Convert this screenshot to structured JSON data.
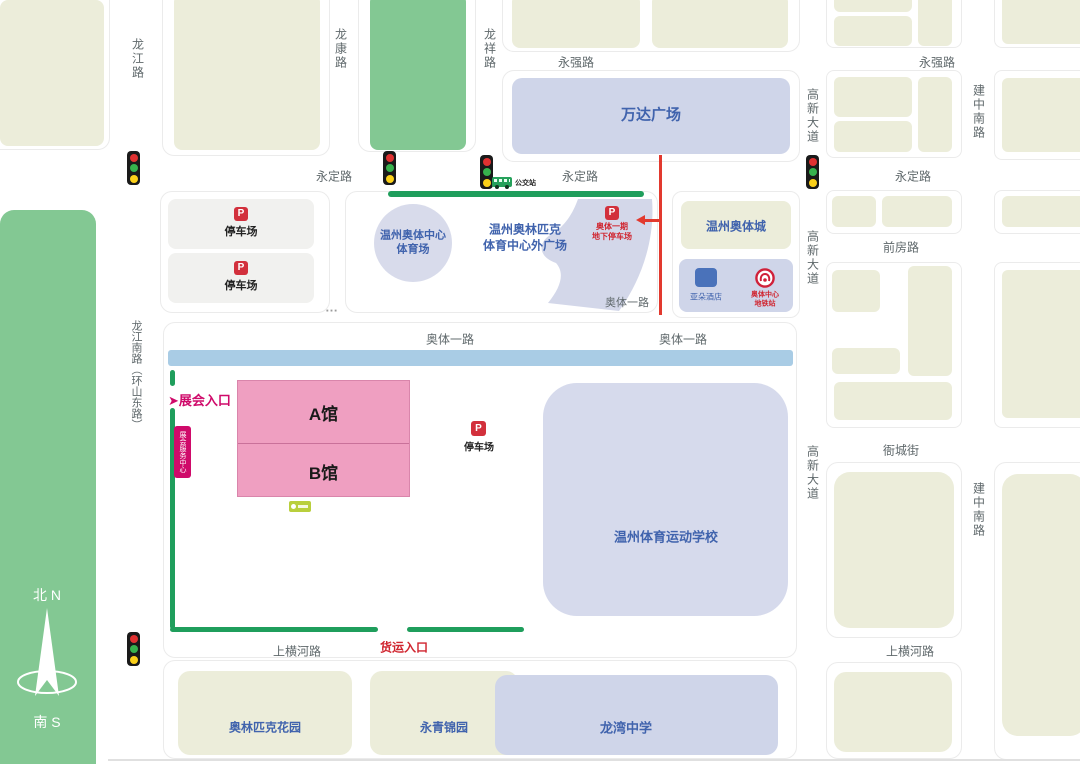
{
  "roads": [
    {
      "label": "龙江路"
    },
    {
      "label": "龙康路"
    },
    {
      "label": "龙祥路"
    },
    {
      "label": "永强路"
    },
    {
      "label": "永强路"
    },
    {
      "label": "高新大道"
    },
    {
      "label": "建中南路"
    },
    {
      "label": "永定路"
    },
    {
      "label": "永定路"
    },
    {
      "label": "永定路"
    },
    {
      "label": "高新大道"
    },
    {
      "label": "前房路"
    },
    {
      "label": "奥体一路"
    },
    {
      "label": "奥体一路"
    },
    {
      "label": "奥体一路"
    },
    {
      "label": "龙江南路（环山东路）"
    },
    {
      "label": "高新大道"
    },
    {
      "label": "衙城街"
    },
    {
      "label": "建中南路"
    },
    {
      "label": "上横河路"
    },
    {
      "label": "上横河路"
    }
  ],
  "poi": {
    "wanda": "万达广场",
    "parking": "停车场",
    "p_letter": "P",
    "stadium_l1": "温州奥体中心",
    "stadium_l2": "体育场",
    "plaza_l1": "温州奥林匹克",
    "plaza_l2": "体育中心外广场",
    "underground_l1": "奥体一期",
    "underground_l2": "地下停车场",
    "aoti_city": "温州奥体城",
    "hotel": "亚朵酒店",
    "metro_l1": "奥体中心",
    "metro_l2": "地铁站",
    "hall_a": "A馆",
    "hall_b": "B馆",
    "school": "温州体育运动学校",
    "olympic_garden": "奥林匹克花园",
    "yongqing": "永青锦园",
    "longwan": "龙湾中学"
  },
  "annotations": {
    "expo_entrance": "展会入口",
    "arrow": "➤",
    "service_center": "展会服务中心",
    "freight_entrance": "货运入口",
    "bus_stop": "公交站",
    "ellipsis": "…",
    "north": "北 N",
    "south": "南 S"
  },
  "colors": {
    "accent_magenta": "#cf0a6a",
    "accent_red": "#d2303c",
    "route_green": "#1f9e5c",
    "road_band_blue": "#a9cce5",
    "poi_blue": "#4063ad",
    "hall_pink": "#ef9fc1",
    "block_cream": "#ecedda",
    "block_lavender": "#cfd5e9",
    "park_green": "#83c893"
  }
}
